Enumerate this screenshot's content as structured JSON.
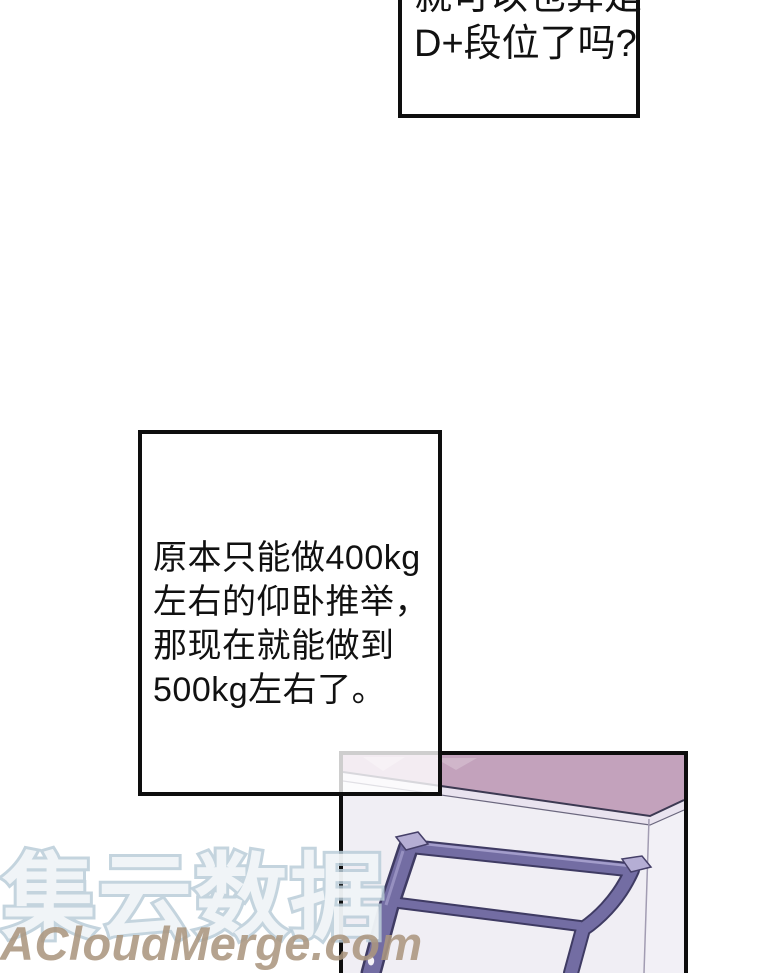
{
  "comic": {
    "bubble_top": {
      "line1": "就可以也算是",
      "line2": "D+段位了吗?"
    },
    "bubble_middle": {
      "line1": "原本只能做400kg",
      "line2": "左右的仰卧推举，",
      "line3": "那现在就能做到",
      "line4": "500kg左右了。"
    },
    "watermarks": {
      "cn": "集云数据",
      "en": "ACloudMerge.com"
    },
    "scene": {
      "description": "room corner with pink ceiling and purple pull-up rack"
    },
    "colors": {
      "page_bg": "#ffffff",
      "bubble_border": "#0e0e0e",
      "ceiling_pink": "#c3a2bc",
      "ceiling_trim": "#e9e3ef",
      "wall": "#f0eef4",
      "rack_main": "#736da3",
      "rack_light": "#b5aed4",
      "rack_dark": "#3f3b63",
      "watermark_cn_stroke": "#baccd8",
      "watermark_en": "#ab9680"
    }
  }
}
